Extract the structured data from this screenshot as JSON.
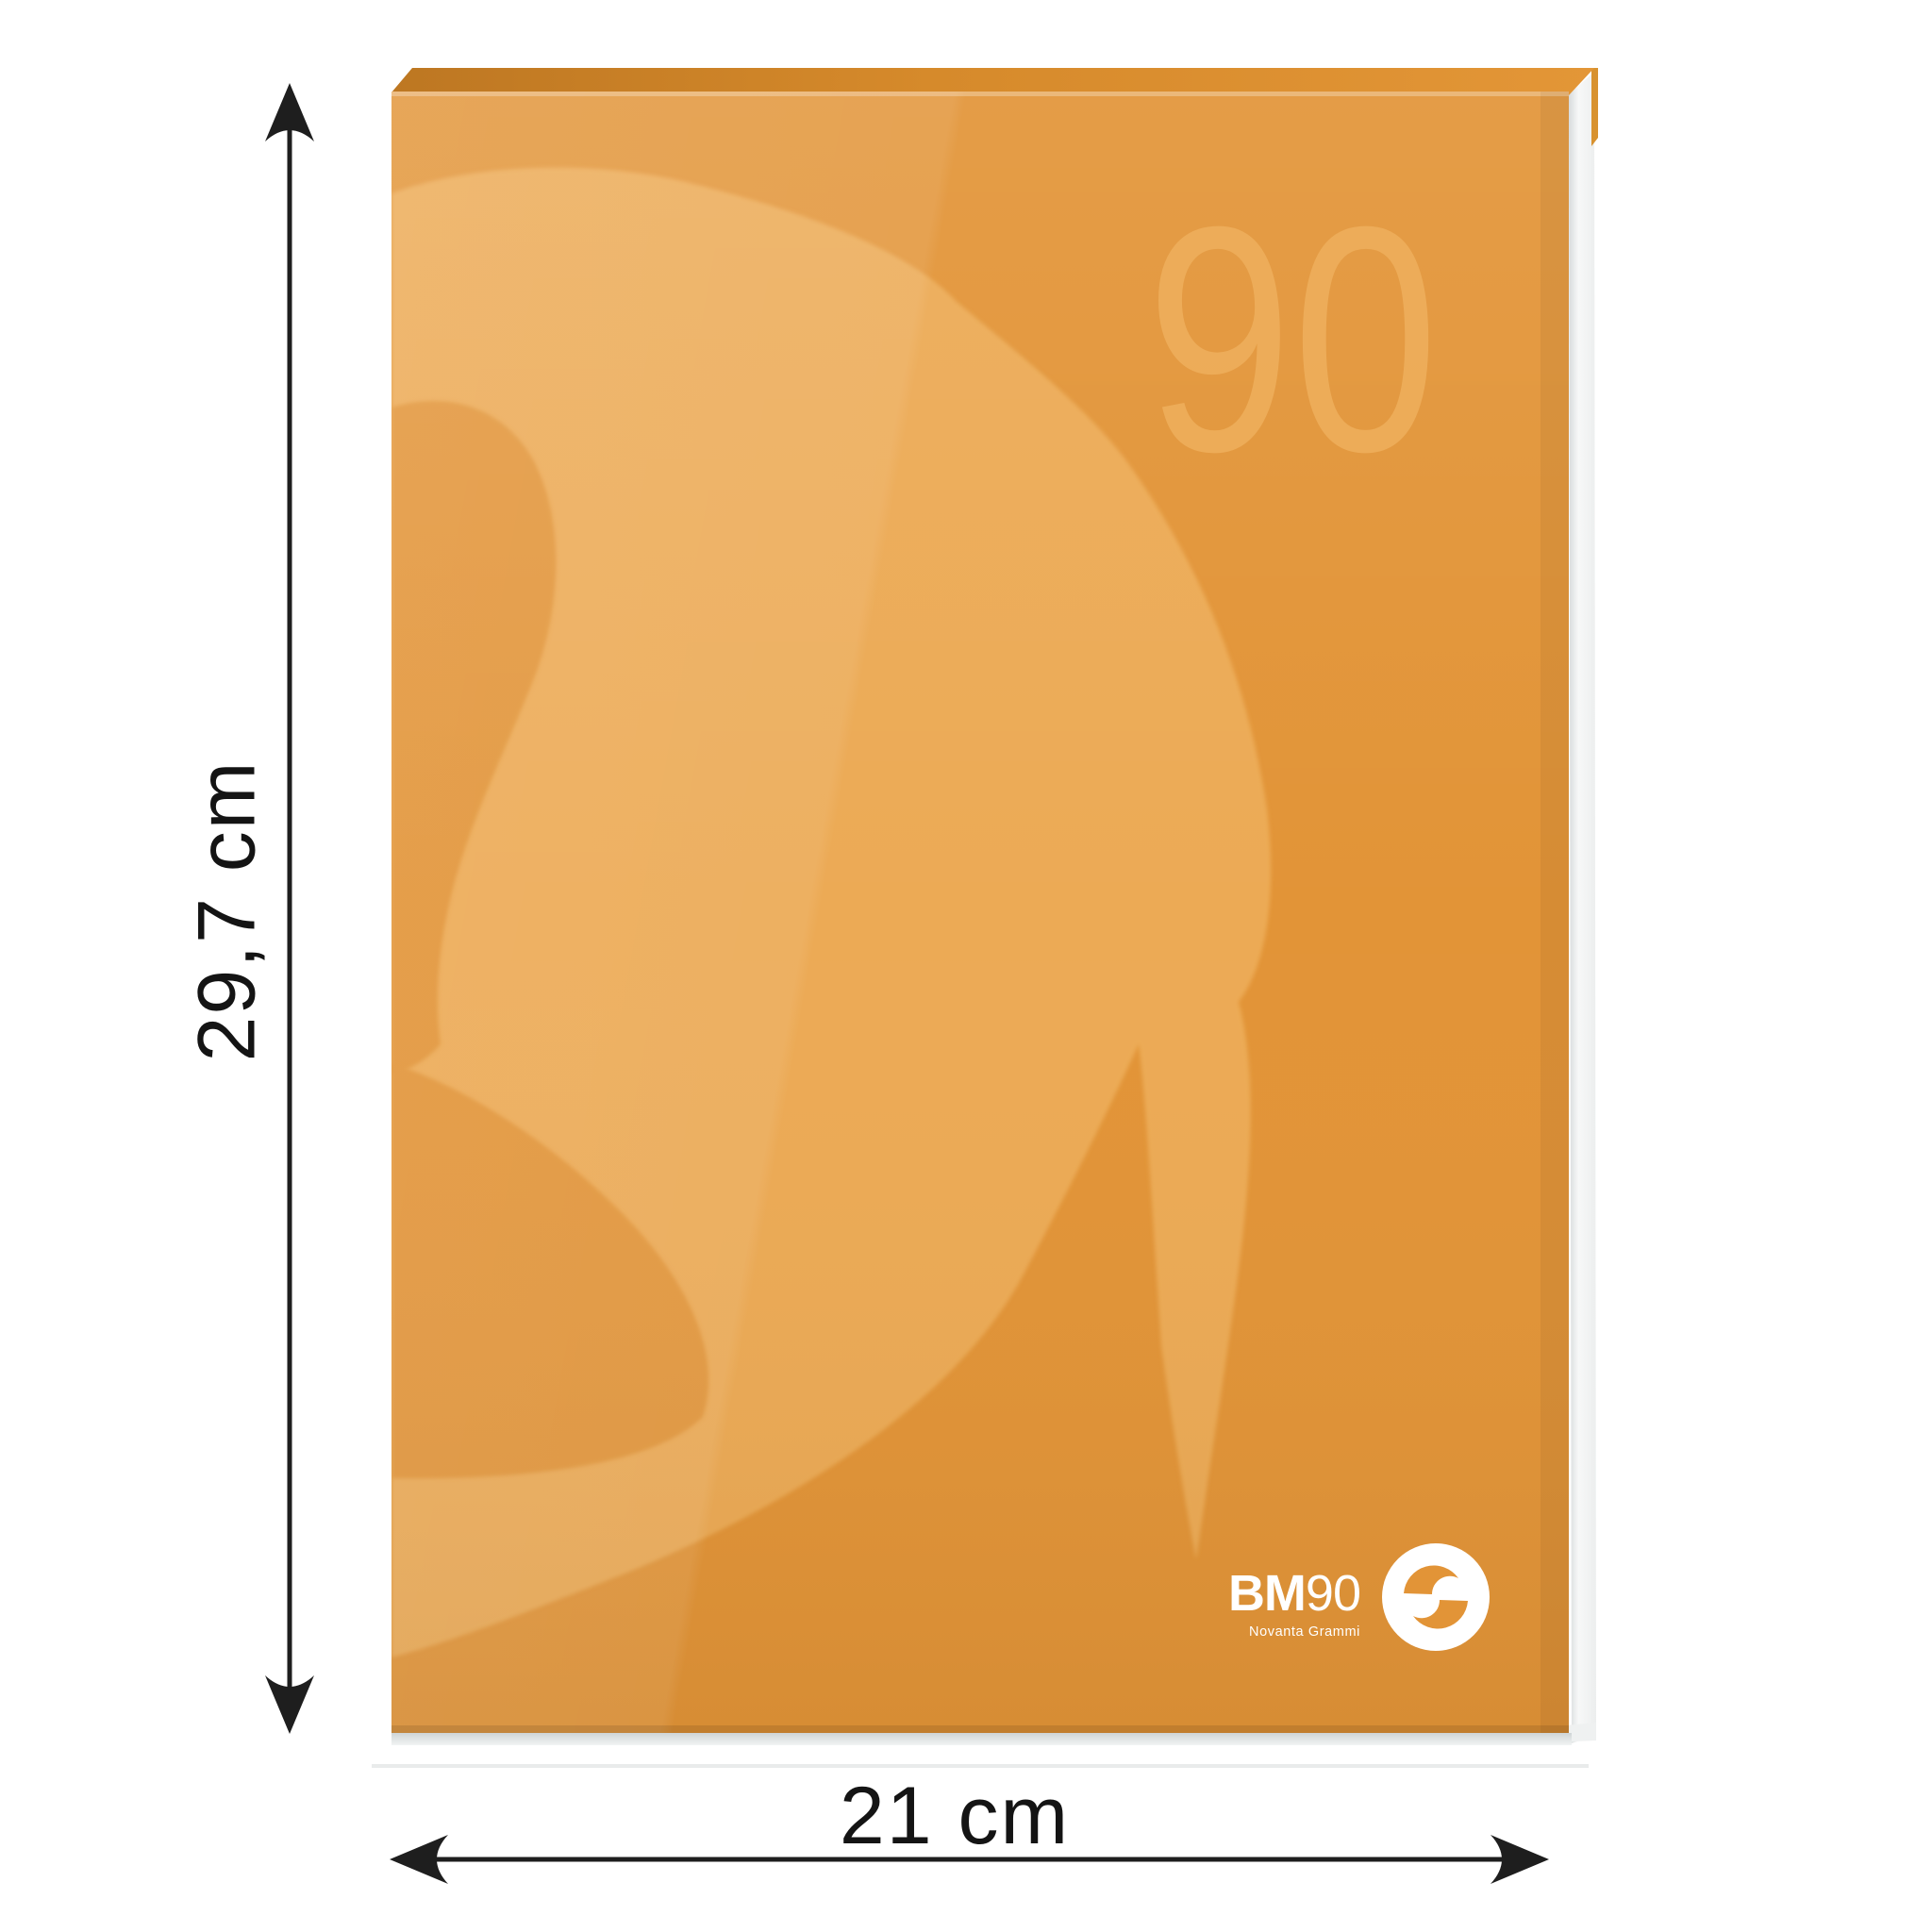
{
  "cover": {
    "watermark": "90",
    "brand": {
      "bm": "BM",
      "ninety": "90",
      "tagline": "Novanta Grammi"
    }
  },
  "dimensions": {
    "height_label": "29,7 cm",
    "width_label": "21 cm"
  },
  "colors": {
    "cover_base": "#e29437",
    "cover_swirl": "#ecaa54",
    "cover_top_dark": "#c07a24",
    "watermark": "#eeae5b",
    "pages": "#f7f8f8",
    "back_sliver": "#d8922f",
    "arrow": "#1e1e1e",
    "label_text": "#141414",
    "logo_white": "#ffffff",
    "shadow_line": "#e9ebeb"
  }
}
